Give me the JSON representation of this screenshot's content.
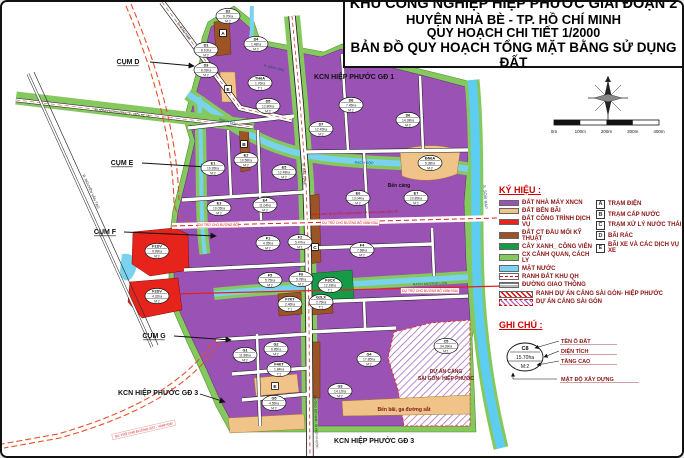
{
  "title": {
    "line1": "KHU CÔNG NGHIỆP HIỆP PHƯỚC GIAI ĐOẠN 2",
    "line2": "HUYỆN NHÀ BÈ - TP. HỒ CHÍ MINH",
    "line3": "QUY HOẠCH CHI TIẾT 1/2000",
    "line4": "BẢN ĐỒ QUY HOẠCH TỔNG MẶT BẰNG SỬ DỤNG ĐẤT"
  },
  "colors": {
    "factory_purple": "#9a52b5",
    "wharf_tan": "#f0c488",
    "service_red": "#e6241c",
    "technical_brown": "#9c5426",
    "park_green": "#169a45",
    "buffer_green": "#85c95e",
    "water_blue": "#7ad3ee",
    "reserve_red": "#cc1111",
    "legend_text": "#8a1515"
  },
  "scale_bar": {
    "labels": [
      "0m",
      "100m",
      "200m",
      "300m",
      "400m"
    ]
  },
  "legend": {
    "header": "KÝ HIỆU :",
    "items": [
      {
        "label": "ĐẤT NHÀ MÁY XNCN",
        "type": "fill",
        "color": "#9a52b5"
      },
      {
        "label": "ĐẤT BẾN BÃI",
        "type": "fill",
        "color": "#f0c488"
      },
      {
        "label": "ĐẤT CÔNG TRÌNH DỊCH VỤ",
        "type": "fill",
        "color": "#e6241c"
      },
      {
        "label": "ĐẤT CT ĐẦU MỐI KỸ THUẬT",
        "type": "fill",
        "color": "#9c5426"
      },
      {
        "label": "CÂY XANH_ CÔNG VIÊN",
        "type": "fill",
        "color": "#169a45"
      },
      {
        "label": "CX CẢNH QUAN, CÁCH LY",
        "type": "fill",
        "color": "#85c95e"
      },
      {
        "label": "MẶT NƯỚC",
        "type": "fill",
        "color": "#7ad3ee"
      },
      {
        "label": "RANH ĐẤT KHU QH",
        "type": "dash-red"
      },
      {
        "label": "ĐƯỜNG GIAO THÔNG",
        "type": "road-lines"
      }
    ],
    "wide_items": [
      {
        "label": "RANH DỰ ÁN CẢNG SÀI GÒN- HIỆP PHƯỚC",
        "type": "hatch-red"
      },
      {
        "label": "DỰ ÁN CẢNG SÀI GÒN",
        "type": "hatch-purple"
      }
    ],
    "letter_items": [
      {
        "k": "A",
        "label": "TRẠM ĐIỆN"
      },
      {
        "k": "B",
        "label": "TRẠM CẤP NƯỚC"
      },
      {
        "k": "C",
        "label": "TRẠM XỬ LÝ NƯỚC THẢI"
      },
      {
        "k": "D",
        "label": "BÃI RÁC"
      },
      {
        "k": "E",
        "label": "BÃI XE VÀ CÁC DỊCH VỤ XE"
      }
    ]
  },
  "notes": {
    "header": "GHI CHÚ :",
    "sample": {
      "id": "C8",
      "area": "15.70ha",
      "floors": "M:2"
    },
    "labels": [
      "TÊN Ô ĐẤT",
      "DIỆN TÍCH",
      "TẦNG CAO",
      "MẬT ĐỘ XÂY DỰNG"
    ]
  },
  "map": {
    "labels": [
      {
        "t": "KCN HIỆP PHƯỚC GĐ 1",
        "x": 312,
        "y": 77,
        "s": 7,
        "w": "bold",
        "a": "start"
      },
      {
        "t": "KCN HIỆP PHƯỚC GĐ 3",
        "x": 116,
        "y": 393,
        "s": 7,
        "w": "bold",
        "a": "start"
      },
      {
        "t": "KCN HIỆP PHƯỚC GĐ 3",
        "x": 332,
        "y": 441,
        "s": 7,
        "w": "bold",
        "a": "start"
      },
      {
        "t": "CỤM D",
        "x": 126,
        "y": 62,
        "s": 7,
        "w": "bold",
        "u": 1
      },
      {
        "t": "CỤM E",
        "x": 120,
        "y": 163,
        "s": 7,
        "w": "bold",
        "u": 1
      },
      {
        "t": "CỤM F",
        "x": 103,
        "y": 232,
        "s": 7,
        "w": "bold",
        "u": 1
      },
      {
        "t": "CỤM G",
        "x": 152,
        "y": 336,
        "s": 7,
        "w": "bold",
        "u": 1
      },
      {
        "t": "Bến cảng",
        "x": 397,
        "y": 185,
        "s": 5,
        "w": "bold"
      },
      {
        "t": "DỰ ÁN CẢNG",
        "x": 444,
        "y": 371,
        "s": 5,
        "w": "bold",
        "c": "#7a1515"
      },
      {
        "t": "SÀI GÒN- HIỆP PHƯỚC",
        "x": 444,
        "y": 378,
        "s": 5,
        "w": "bold",
        "c": "#7a1515"
      },
      {
        "t": "Bến bãi, ga đường sắt",
        "x": 402,
        "y": 409,
        "s": 5,
        "w": "bold",
        "c": "#7a1515"
      },
      {
        "t": "RẠCH ĐỘP",
        "x": 226,
        "y": 121,
        "s": 3.6,
        "r": 16,
        "c": "#14506b"
      },
      {
        "t": "RẠCH ĐỘP",
        "x": 362,
        "y": 162,
        "s": 3.6,
        "r": 2,
        "c": "#14506b"
      },
      {
        "t": "RẠCH MƯƠNG LỚN",
        "x": 428,
        "y": 283,
        "s": 3.6,
        "r": -2,
        "c": "#14506b"
      },
      {
        "t": "S. SOÀI RẠP",
        "x": 482,
        "y": 195,
        "s": 4,
        "r": 86,
        "c": "#14506b"
      },
      {
        "t": "R. ĐÌNH ÔNG",
        "x": 272,
        "y": 67,
        "s": 3.4,
        "r": 14,
        "c": "#14506b"
      },
      {
        "t": "Đ. BẮC NAM",
        "x": 181,
        "y": 30,
        "s": 3.6,
        "r": 54,
        "c": "#222"
      },
      {
        "t": "Đ. BẮC NAM",
        "x": 301,
        "y": 172,
        "s": 3.6,
        "r": 87,
        "c": "#222"
      },
      {
        "t": "ĐƯỜNG BỘ NAM - Đi HIỆP PHƯỚC",
        "x": 313,
        "y": 420,
        "s": 3.2,
        "r": 88,
        "c": "#222"
      },
      {
        "t": "Đ. NGUYỄN VĂN TẠO",
        "x": 88,
        "y": 190,
        "s": 3.6,
        "r": 66,
        "c": "#222"
      },
      {
        "t": "ĐƯỜNG MỚI NGOÀI T - MỚI SL 35",
        "x": 120,
        "y": 112,
        "s": 3.4,
        "r": 7,
        "c": "#143a14"
      },
      {
        "t": "DỰ TRỮ CHO ĐƯỜNG BỘ",
        "x": 216,
        "y": 224,
        "s": 3.2,
        "c": "#cc1111",
        "bg": 1
      },
      {
        "t": "DỰ TRỮ CHO ĐƯỜNG BỘ VÀNH ĐAI",
        "x": 348,
        "y": 222,
        "s": 3.2,
        "c": "#cc1111",
        "bg": 1
      },
      {
        "t": "DỰ TRỮ CHO ĐƯỜNG BỘ VÀNH ĐAI",
        "x": 428,
        "y": 290,
        "s": 3.2,
        "c": "#cc1111",
        "bg": 1
      },
      {
        "t": "DỰ TRỮ CHO ĐƯỜNG SẮT - VÀNH ĐAI",
        "x": 142,
        "y": 429,
        "s": 3.2,
        "r": -13,
        "c": "#cc1111",
        "bg": 1
      },
      {
        "t": "DÀNH CHO TIM ĐƯỜNG ĐIỆN 220KV VÀ HÀNH LANG BẢO VỆ",
        "x": 352,
        "y": 212,
        "s": 3,
        "r": -2,
        "c": "#cc1111"
      }
    ],
    "parcels": [
      {
        "id": "D2",
        "area": "9.70ha",
        "fl": "M:2",
        "x": 226,
        "y": 14
      },
      {
        "id": "D1",
        "area": "8.10ha",
        "fl": "M:2",
        "x": 204,
        "y": 48
      },
      {
        "id": "D3",
        "area": "8.03ha",
        "fl": "M:2",
        "x": 204,
        "y": 68
      },
      {
        "id": "D4",
        "area": "1.48ha",
        "fl": "M:2",
        "x": 254,
        "y": 42
      },
      {
        "id": "TH6A",
        "area": "1.76ha",
        "fl": "T:1",
        "x": 258,
        "y": 81
      },
      {
        "id": "D5",
        "area": "12.80ha",
        "fl": "M:2",
        "x": 266,
        "y": 104
      },
      {
        "id": "D8",
        "area": "7.45ha",
        "fl": "M:2",
        "x": 349,
        "y": 103
      },
      {
        "id": "D6",
        "area": "14.38ha",
        "fl": "M:2",
        "x": 406,
        "y": 118
      },
      {
        "id": "D7",
        "area": "12.45ha",
        "fl": "M:2",
        "x": 319,
        "y": 127
      },
      {
        "id": "E1",
        "area": "10.95ha",
        "fl": "M:2",
        "x": 211,
        "y": 166
      },
      {
        "id": "E2",
        "area": "10.58ha",
        "fl": "M:2",
        "x": 244,
        "y": 158
      },
      {
        "id": "E3",
        "area": "10.05ha",
        "fl": "M:2",
        "x": 217,
        "y": 206
      },
      {
        "id": "E4",
        "area": "11.04ha",
        "fl": "M:2",
        "x": 263,
        "y": 203
      },
      {
        "id": "E5",
        "area": "12.48ha",
        "fl": "M:2",
        "x": 282,
        "y": 170
      },
      {
        "id": "E6",
        "area": "13.04ha",
        "fl": "M:2",
        "x": 356,
        "y": 196
      },
      {
        "id": "E7",
        "area": "10.89ha",
        "fl": "M:2",
        "x": 414,
        "y": 196
      },
      {
        "id": "ĐN6A",
        "area": "5.38ha",
        "fl": "M:2",
        "x": 428,
        "y": 161
      },
      {
        "id": "F1",
        "area": "4.35ha",
        "fl": "M:2",
        "x": 266,
        "y": 241
      },
      {
        "id": "F2",
        "area": "5.47ha",
        "fl": "M:1",
        "x": 298,
        "y": 240
      },
      {
        "id": "F4",
        "area": "7.68ha",
        "fl": "M:2",
        "x": 360,
        "y": 248
      },
      {
        "id": "F5",
        "area": "5.75ha",
        "fl": "M:2",
        "x": 268,
        "y": 278
      },
      {
        "id": "F6",
        "area": "5.78ha",
        "fl": "M:2",
        "x": 299,
        "y": 277
      },
      {
        "id": "F1DV",
        "area": "9.99ha",
        "fl": "M:2",
        "x": 155,
        "y": 249
      },
      {
        "id": "F2DV",
        "area": "4.32ha",
        "fl": "M:2",
        "x": 155,
        "y": 294
      },
      {
        "id": "F7KT",
        "area": "2.46ha",
        "fl": "T:1",
        "x": 288,
        "y": 302
      },
      {
        "id": "G2LX",
        "area": "2.75ha",
        "fl": "T:1",
        "x": 319,
        "y": 300
      },
      {
        "id": "F3CX",
        "area": "12.18ha",
        "fl": "T:1",
        "x": 328,
        "y": 283
      },
      {
        "id": "F4KT",
        "area": "1.84ha",
        "fl": "T:1",
        "x": 277,
        "y": 367
      },
      {
        "id": "G1",
        "area": "11.88ha",
        "fl": "M:2",
        "x": 243,
        "y": 353
      },
      {
        "id": "G2",
        "area": "8.85ha",
        "fl": "M:2",
        "x": 274,
        "y": 347
      },
      {
        "id": "G3",
        "area": "14.12ha",
        "fl": "M:2",
        "x": 338,
        "y": 389
      },
      {
        "id": "G4",
        "area": "17.85ha",
        "fl": "M:2",
        "x": 367,
        "y": 357
      },
      {
        "id": "G5",
        "area": "4.55ha",
        "fl": "M:2",
        "x": 272,
        "y": 401
      },
      {
        "id": "C5",
        "area": "34.39ha",
        "fl": "M:1",
        "x": 444,
        "y": 344
      }
    ],
    "markers": [
      {
        "k": "A",
        "x": 221,
        "y": 31
      },
      {
        "k": "E",
        "x": 226,
        "y": 87
      },
      {
        "k": "B",
        "x": 242,
        "y": 142
      },
      {
        "k": "C",
        "x": 313,
        "y": 245
      },
      {
        "k": "E",
        "x": 273,
        "y": 384
      }
    ]
  }
}
